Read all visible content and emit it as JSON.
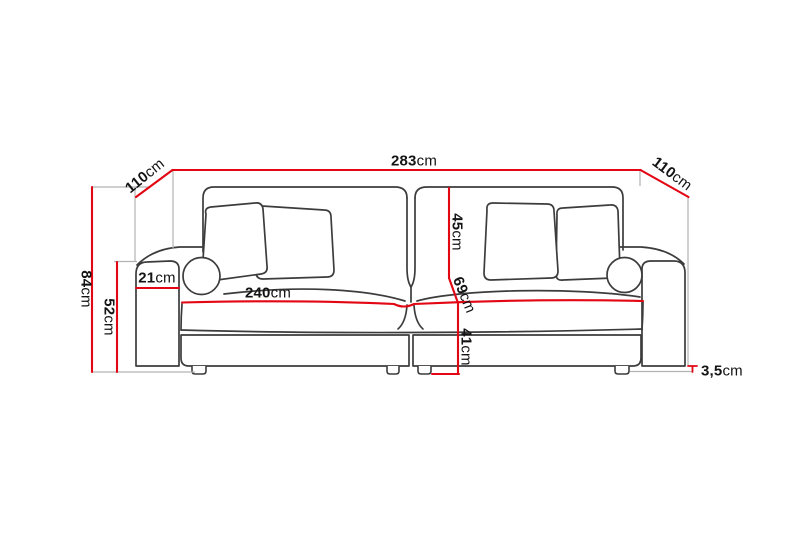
{
  "diagram": {
    "subject": "sofa-dimension-line-drawing",
    "colors": {
      "dimension_line": "#e30613",
      "outline": "#3c3c3c",
      "construction_line": "#b3b3b3",
      "label_text": "#141414",
      "background": "#ffffff"
    },
    "dimensions": {
      "total_width": {
        "value": "283",
        "unit": "cm"
      },
      "depth_left": {
        "value": "110",
        "unit": "cm"
      },
      "depth_right": {
        "value": "110",
        "unit": "cm"
      },
      "total_height": {
        "value": "84",
        "unit": "cm"
      },
      "arm_height": {
        "value": "52",
        "unit": "cm"
      },
      "arm_width": {
        "value": "21",
        "unit": "cm"
      },
      "seat_width": {
        "value": "240",
        "unit": "cm"
      },
      "back_cushion_height": {
        "value": "45",
        "unit": "cm"
      },
      "seat_depth": {
        "value": "69",
        "unit": "cm"
      },
      "seat_height": {
        "value": "41",
        "unit": "cm"
      },
      "leg_height": {
        "value": "3,5",
        "unit": "cm"
      }
    }
  }
}
